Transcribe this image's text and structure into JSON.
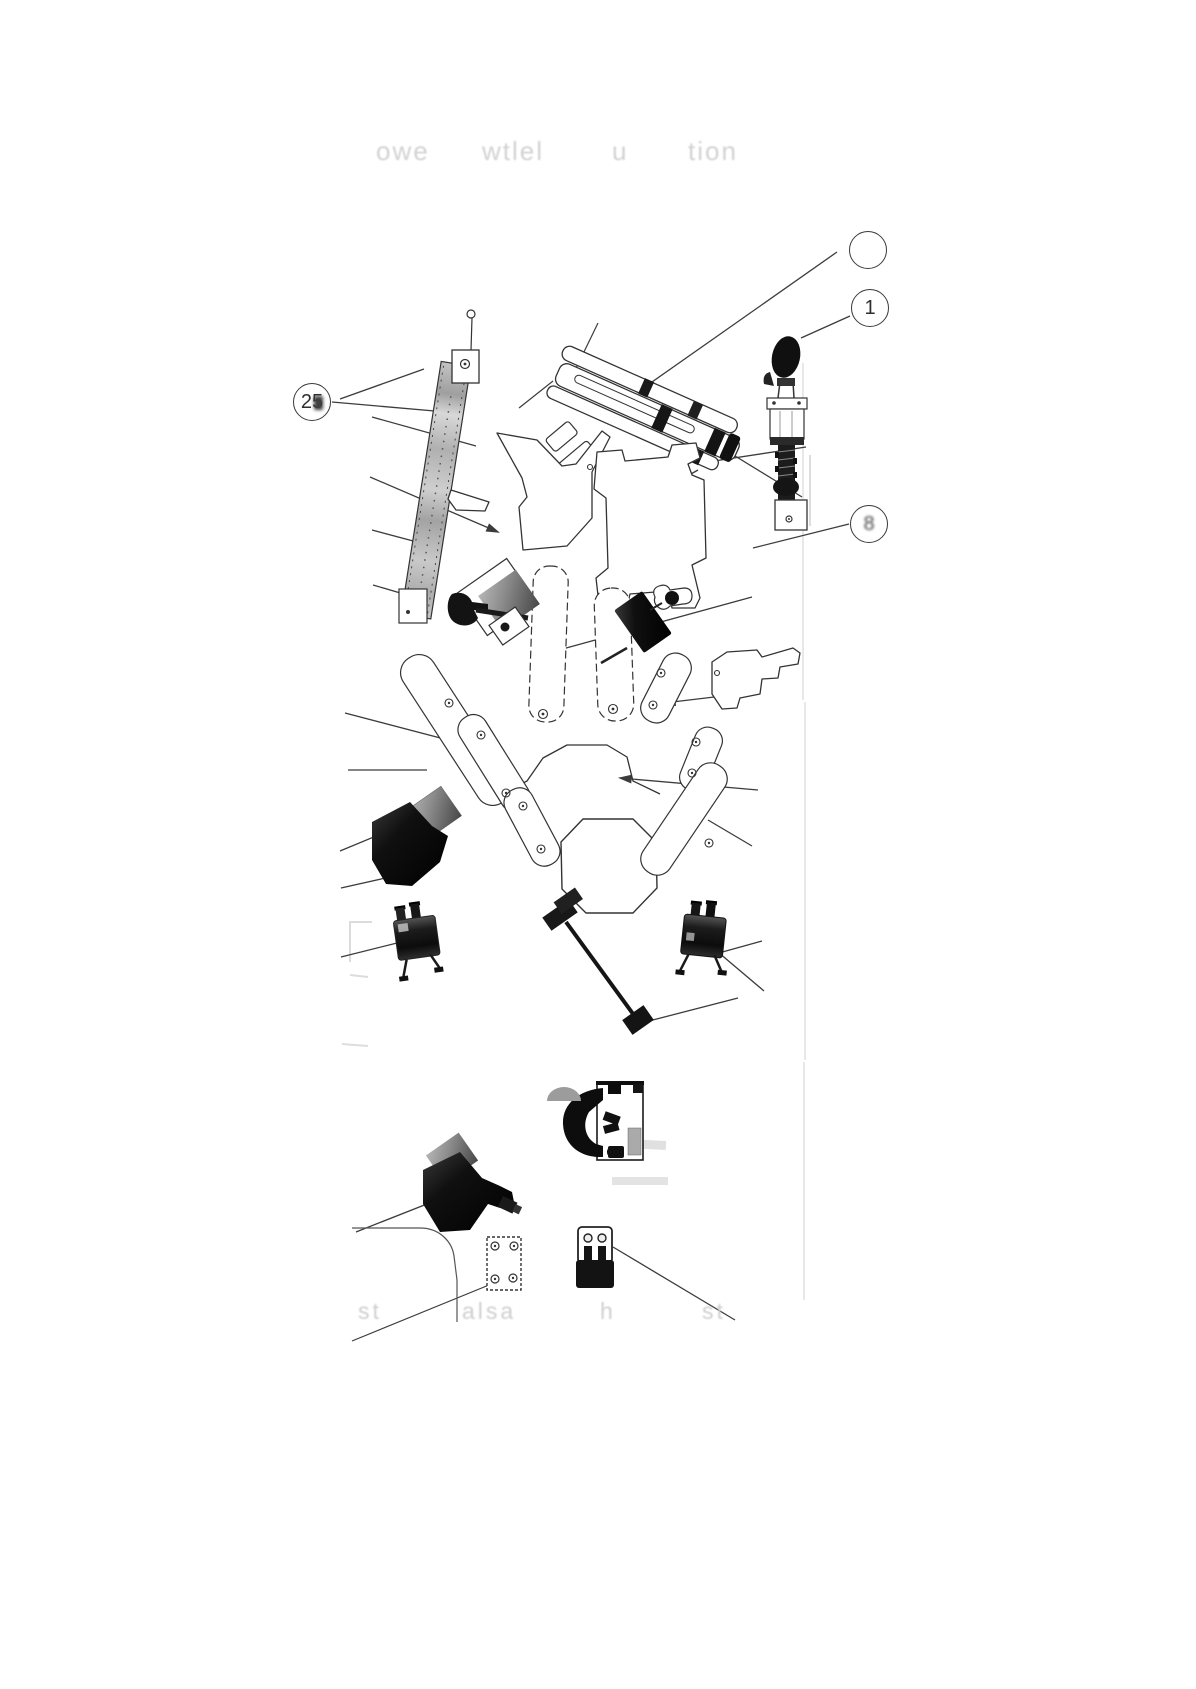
{
  "page": {
    "title_fragments": [
      "owe",
      "wtlel",
      "u",
      "tion"
    ],
    "footer_fragments": [
      "st",
      "alsa",
      "h",
      "st"
    ]
  },
  "figure": {
    "callouts": [
      {
        "label": ""
      },
      {
        "label": "1"
      },
      {
        "label": "25"
      },
      {
        "label": "8"
      }
    ]
  },
  "colors": {
    "ink": "#333333",
    "paper": "#ffffff",
    "faded_text": "#d2d2d2"
  }
}
